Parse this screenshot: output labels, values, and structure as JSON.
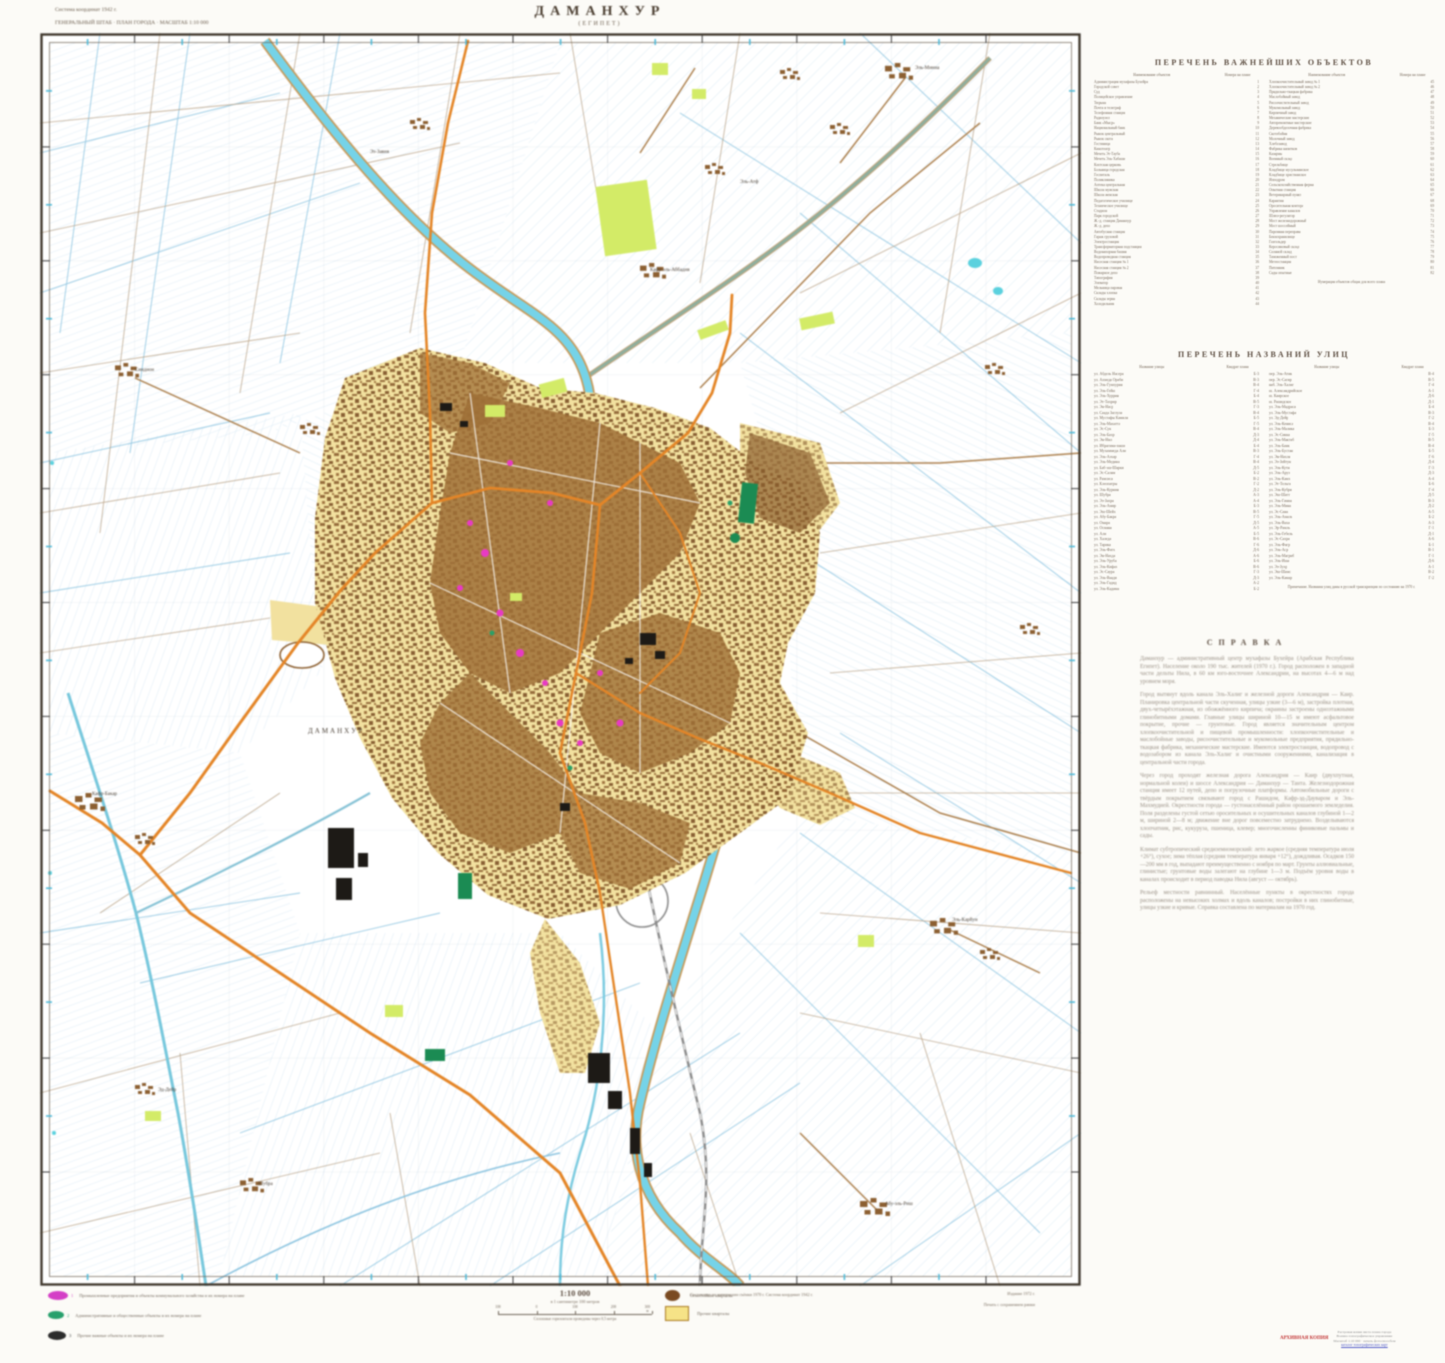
{
  "sheet": {
    "title": "ДАМАНХУР",
    "subtitle": "(ЕГИПЕТ)",
    "corner_note_1": "Система координат 1942 г.",
    "corner_note_2": "ГЕНЕРАЛЬНЫЙ ШТАБ  ·  ПЛАН ГОРОДА  ·  МАСШТАБ 1:10 000"
  },
  "objects_index": {
    "title": "ПЕРЕЧЕНЬ ВАЖНЕЙШИХ ОБЪЕКТОВ",
    "name_header": "Наименование объектов",
    "num_header": "Номера на плане",
    "left": [
      [
        "Администрация мухафазы Бухейра",
        "1"
      ],
      [
        "Городской совет",
        "2"
      ],
      [
        "Суд",
        "3"
      ],
      [
        "Полицейское управление",
        "4"
      ],
      [
        "Тюрьма",
        "5"
      ],
      [
        "Почта и телеграф",
        "6"
      ],
      [
        "Телефонная станция",
        "7"
      ],
      [
        "Радиоузел",
        "8"
      ],
      [
        "Банк «Мыср»",
        "9"
      ],
      [
        "Национальный банк",
        "10"
      ],
      [
        "Рынок центральный",
        "11"
      ],
      [
        "Рынок скота",
        "12"
      ],
      [
        "Гостиница",
        "13"
      ],
      [
        "Кинотеатр",
        "14"
      ],
      [
        "Мечеть Эт-Тауба",
        "15"
      ],
      [
        "Мечеть Эль-Хабаши",
        "16"
      ],
      [
        "Коптская церковь",
        "17"
      ],
      [
        "Больница городская",
        "18"
      ],
      [
        "Госпиталь",
        "19"
      ],
      [
        "Поликлиника",
        "20"
      ],
      [
        "Аптека центральная",
        "21"
      ],
      [
        "Школа мужская",
        "22"
      ],
      [
        "Школа женская",
        "23"
      ],
      [
        "Педагогическое училище",
        "24"
      ],
      [
        "Техническое училище",
        "25"
      ],
      [
        "Стадион",
        "26"
      ],
      [
        "Парк городской",
        "27"
      ],
      [
        "Ж.-д. станция Даманхур",
        "28"
      ],
      [
        "Ж.-д. депо",
        "29"
      ],
      [
        "Автобусная станция",
        "30"
      ],
      [
        "Гараж грузовой",
        "31"
      ],
      [
        "Электростанция",
        "32"
      ],
      [
        "Трансформаторная подстанция",
        "33"
      ],
      [
        "Водонапорная башня",
        "34"
      ],
      [
        "Водопроводная станция",
        "35"
      ],
      [
        "Насосная станция № 1",
        "36"
      ],
      [
        "Насосная станция № 2",
        "37"
      ],
      [
        "Пожарное депо",
        "38"
      ],
      [
        "Типография",
        "39"
      ],
      [
        "Элеватор",
        "40"
      ],
      [
        "Мельница паровая",
        "41"
      ],
      [
        "Склады хлопка",
        "42"
      ],
      [
        "Склады зерна",
        "43"
      ],
      [
        "Холодильник",
        "44"
      ]
    ],
    "right": [
      [
        "Хлопкоочистительный завод № 1",
        "45"
      ],
      [
        "Хлопкоочистительный завод № 2",
        "46"
      ],
      [
        "Прядильно-ткацкая фабрика",
        "47"
      ],
      [
        "Маслобойный завод",
        "48"
      ],
      [
        "Рисоочистительный завод",
        "49"
      ],
      [
        "Мукомольный завод",
        "50"
      ],
      [
        "Кирпичный завод",
        "51"
      ],
      [
        "Механические мастерские",
        "52"
      ],
      [
        "Авторемонтные мастерские",
        "53"
      ],
      [
        "Деревообделочная фабрика",
        "54"
      ],
      [
        "Скотобойня",
        "55"
      ],
      [
        "Молочный завод",
        "56"
      ],
      [
        "Хлебозавод",
        "57"
      ],
      [
        "Фабрика напитков",
        "58"
      ],
      [
        "Казармы",
        "59"
      ],
      [
        "Военный склад",
        "60"
      ],
      [
        "Стрельбище",
        "61"
      ],
      [
        "Кладбище мусульманское",
        "62"
      ],
      [
        "Кладбище христианское",
        "63"
      ],
      [
        "Ипподром",
        "64"
      ],
      [
        "Сельскохозяйственная ферма",
        "65"
      ],
      [
        "Опытная станция",
        "66"
      ],
      [
        "Ветеринарный пункт",
        "67"
      ],
      [
        "Карантин",
        "68"
      ],
      [
        "Оросительная контора",
        "69"
      ],
      [
        "Управление каналов",
        "70"
      ],
      [
        "Шлюз-регулятор",
        "71"
      ],
      [
        "Мост железнодорожный",
        "72"
      ],
      [
        "Мост шоссейный",
        "73"
      ],
      [
        "Паромная переправа",
        "74"
      ],
      [
        "Бензохранилище",
        "75"
      ],
      [
        "Газгольдер",
        "76"
      ],
      [
        "Керосиновый склад",
        "77"
      ],
      [
        "Соляной склад",
        "78"
      ],
      [
        "Таможенный пост",
        "79"
      ],
      [
        "Метеостанция",
        "80"
      ],
      [
        "Питомник",
        "81"
      ],
      [
        "Сады опытные",
        "82"
      ]
    ],
    "footnote": "Нумерация объектов общая для всего плана"
  },
  "streets_index": {
    "title": "ПЕРЕЧЕНЬ НАЗВАНИЙ УЛИЦ",
    "name_header": "Название улицы",
    "num_header": "Квадрат плана",
    "left": [
      [
        "ул. Абдель Насера",
        "Б-3"
      ],
      [
        "ул. Ахмеда Ораби",
        "В-3"
      ],
      [
        "ул. Эль-Гумхурия",
        "В-4"
      ],
      [
        "ул. Эль-Гейш",
        "Г-4"
      ],
      [
        "ул. Эль-Хуррия",
        "Б-4"
      ],
      [
        "ул. Эт-Тахрир",
        "В-5"
      ],
      [
        "ул. Эн-Наср",
        "Г-3"
      ],
      [
        "ул. Саада Заглула",
        "В-4"
      ],
      [
        "ул. Мустафы Камиля",
        "Б-5"
      ],
      [
        "ул. Эль-Махатта",
        "Г-5"
      ],
      [
        "ул. Эс-Сук",
        "В-4"
      ],
      [
        "ул. Эль-Бахр",
        "Д-3"
      ],
      [
        "ул. Эн-Нил",
        "Д-4"
      ],
      [
        "ул. Ибрагима-паши",
        "Б-4"
      ],
      [
        "ул. Мухаммеда Али",
        "В-3"
      ],
      [
        "ул. Эль-Азхар",
        "Г-4"
      ],
      [
        "ул. Эль-Медина",
        "В-4"
      ],
      [
        "ул. Баб-эш-Шарки",
        "Д-5"
      ],
      [
        "ул. Эс-Салям",
        "Б-2"
      ],
      [
        "ул. Рамсиса",
        "В-2"
      ],
      [
        "ул. Клеопатры",
        "Г-2"
      ],
      [
        "ул. Эль-Курния",
        "Д-2"
      ],
      [
        "ул. Шубра",
        "А-3"
      ],
      [
        "ул. Эз-Захра",
        "А-4"
      ],
      [
        "ул. Эль-Амир",
        "Б-3"
      ],
      [
        "ул. Эш-Шейх",
        "В-5"
      ],
      [
        "ул. Абу-Бакра",
        "Г-5"
      ],
      [
        "ул. Омара",
        "Д-5"
      ],
      [
        "ул. Османа",
        "А-5"
      ],
      [
        "ул. Али",
        "Б-5"
      ],
      [
        "ул. Халеда",
        "В-6"
      ],
      [
        "ул. Тарика",
        "Г-6"
      ],
      [
        "ул. Эль-Фатх",
        "Д-6"
      ],
      [
        "ул. Эн-Нахда",
        "А-6"
      ],
      [
        "ул. Эль-Уруба",
        "Б-6"
      ],
      [
        "ул. Эль-Кифах",
        "В-6"
      ],
      [
        "ул. Эс-Саура",
        "Г-3"
      ],
      [
        "ул. Эль-Ваади",
        "Д-3"
      ],
      [
        "ул. Эль-Гадид",
        "А-2"
      ],
      [
        "ул. Эль-Кадима",
        "Б-2"
      ]
    ],
    "right": [
      [
        "пер. Эль-Атик",
        "В-4"
      ],
      [
        "пер. Эс-Сагир",
        "В-5"
      ],
      [
        "наб. Эль-Халиг",
        "Г-4"
      ],
      [
        "ш. Александрийское",
        "А-1"
      ],
      [
        "ш. Каирское",
        "Д-6"
      ],
      [
        "ш. Рашидское",
        "Д-1"
      ],
      [
        "ул. Эль-Мадраса",
        "Б-4"
      ],
      [
        "ул. Эль-Мустафа",
        "В-3"
      ],
      [
        "ул. Эд-Дейр",
        "Г-2"
      ],
      [
        "ул. Эль-Кениса",
        "В-4"
      ],
      [
        "ул. Эль-Малика",
        "Б-3"
      ],
      [
        "ул. Эс-Сикка",
        "Г-5"
      ],
      [
        "ул. Эль-Мактаб",
        "В-5"
      ],
      [
        "ул. Эль-Банк",
        "В-4"
      ],
      [
        "ул. Эль-Бустан",
        "Б-5"
      ],
      [
        "ул. Эн-Нахля",
        "Г-6"
      ],
      [
        "ул. Эз-Зейтун",
        "Д-4"
      ],
      [
        "ул. Эль-Кутн",
        "Г-3"
      ],
      [
        "ул. Эль-Аруз",
        "Д-3"
      ],
      [
        "ул. Эль-Камх",
        "А-4"
      ],
      [
        "ул. Эт-Тельга",
        "Б-6"
      ],
      [
        "ул. Эль-Кубри",
        "Г-4"
      ],
      [
        "ул. Эш-Шатт",
        "Д-5"
      ],
      [
        "ул. Эль-Гамиа",
        "В-3"
      ],
      [
        "ул. Эль-Мина",
        "Д-2"
      ],
      [
        "ул. Эс-Сана",
        "А-5"
      ],
      [
        "ул. Эль-Амаль",
        "Б-2"
      ],
      [
        "ул. Эль-Ваха",
        "А-3"
      ],
      [
        "ул. Эр-Рамль",
        "Г-1"
      ],
      [
        "ул. Эль-Гебель",
        "Д-1"
      ],
      [
        "ул. Эс-Сахра",
        "А-6"
      ],
      [
        "ул. Эль-Фагр",
        "Б-1"
      ],
      [
        "ул. Эль-Аср",
        "В-1"
      ],
      [
        "ул. Эль-Магриб",
        "Г-1"
      ],
      [
        "ул. Эль-Иша",
        "Д-6"
      ],
      [
        "ул. Эз-Зухр",
        "А-1"
      ],
      [
        "ул. Эш-Шамс",
        "В-2"
      ],
      [
        "ул. Эль-Камар",
        "Г-2"
      ]
    ],
    "footnote": "Примечание. Названия улиц даны в русской транскрипции по состоянию на 1970 г."
  },
  "reference": {
    "title": "СПРАВКА",
    "paragraphs": [
      "Даманхур — административный центр мухафазы Бухейра (Арабская Республика Египет). Население около 190 тыс. жителей (1970 г.). Город расположен в западной части дельты Нила, в 60 км юго-восточнее Александрии, на высотах 4—6 м над уровнем моря.",
      "Город вытянут вдоль канала Эль-Халиг и железной дороги Александрия — Каир. Планировка центральной части скученная, улицы узкие (3—6 м), застройка плотная, двух-четырёхэтажная, из обожжённого кирпича; окраины застроены одноэтажными глинобитными домами. Главные улицы шириной 10—15 м имеют асфальтовое покрытие, прочие — грунтовые. Город является значительным центром хлопкоочистительной и пищевой промышленности: хлопкоочистительные и маслобойные заводы, рисоочистительные и мукомольные предприятия, прядильно-ткацкая фабрика, механические мастерские. Имеются электростанция, водопровод с водозабором из канала Эль-Халиг и очистными сооружениями, канализация в центральной части города.",
      "Через город проходят железная дорога Александрия — Каир (двухпутная, нормальной колеи) и шоссе Александрия — Даманхур — Танта. Железнодорожная станция имеет 12 путей, депо и погрузочные платформы. Автомобильные дороги с твёрдым покрытием связывают город с Рашидом, Кафр-эд-Дауваром и Эль-Махмудией. Окрестности города — густонаселённый район орошаемого земледелия. Поля разделены густой сетью оросительных и осушительных каналов глубиной 1—2 м, шириной 2—8 м; движение вне дорог повсеместно затруднено. Возделываются хлопчатник, рис, кукуруза, пшеница, клевер; многочисленны финиковые пальмы и сады.",
      "Климат субтропический средиземноморский: лето жаркое (средняя температура июля +26°), сухое; зима тёплая (средняя температура января +12°), дождливая. Осадков 150—200 мм в год, выпадают преимущественно с ноября по март. Грунты аллювиальные, глинистые; грунтовые воды залегают на глубине 1—3 м. Подъём уровня воды в каналах происходит в период паводка Нила (август — октябрь).",
      "Рельеф местности равнинный. Населённые пункты в окрестностях города расположены на невысоких холмах и вдоль каналов; постройки в них глинобитные, улицы узкие и кривые. Справка составлена по материалам на 1970 год."
    ]
  },
  "legend": {
    "items": [
      {
        "color": "#d43fc6",
        "num": "1",
        "label": "Промышленные предприятия и объекты коммунального хозяйства и их номера на плане"
      },
      {
        "color": "#27a06c",
        "num": "2",
        "label": "Административные и общественные объекты и их номера на плане"
      },
      {
        "color": "#2c2c2c",
        "num": "3",
        "label": "Прочие важные объекты и их номера на плане"
      }
    ],
    "blocks": [
      {
        "color": "#7a4a21",
        "label": "Огнестойкие кварталы"
      },
      {
        "color": "#f6e387",
        "label": "Прочие кварталы"
      }
    ]
  },
  "scale": {
    "ratio": "1:10 000",
    "note": "в 1 сантиметре 100 метров",
    "bar_labels": [
      "100",
      "0",
      "100",
      "200",
      "300 м"
    ],
    "contour_note": "Сплошные горизонтали проведены через 0,5 метра"
  },
  "footer": {
    "center_note": "Составлено по материалам съёмки 1970 г. Система координат 1942 г.",
    "right_note_1": "Издание 1972 г.",
    "right_note_2": "Печать с сохранением рамки"
  },
  "watermark": {
    "red_label": "АРХИВНАЯ КОПИЯ",
    "lines": [
      "Растровая копия листа плана города",
      "Военно-топографическое управление",
      "Масштаб 1:10 000 · печать фотоспособом"
    ],
    "link_label": "каталог топографических карт"
  },
  "map": {
    "labels": [
      {
        "t": "Эз-Завия",
        "x": 330,
        "y": 120
      },
      {
        "t": "Кафр-эль-Аббадия",
        "x": 610,
        "y": 238
      },
      {
        "t": "Эль-Миниа",
        "x": 875,
        "y": 36
      },
      {
        "t": "Синдион",
        "x": 95,
        "y": 338
      },
      {
        "t": "Эль-Атф",
        "x": 700,
        "y": 150
      },
      {
        "t": "Кафр-Бакар",
        "x": 52,
        "y": 762
      },
      {
        "t": "ДАМАНХУР",
        "x": 268,
        "y": 700
      },
      {
        "t": "Эль-Карйун",
        "x": 912,
        "y": 888
      },
      {
        "t": "Эд-Дейр",
        "x": 118,
        "y": 1058
      },
      {
        "t": "Шубра",
        "x": 218,
        "y": 1152
      },
      {
        "t": "Абу-эль-Риш",
        "x": 845,
        "y": 1172
      }
    ]
  }
}
